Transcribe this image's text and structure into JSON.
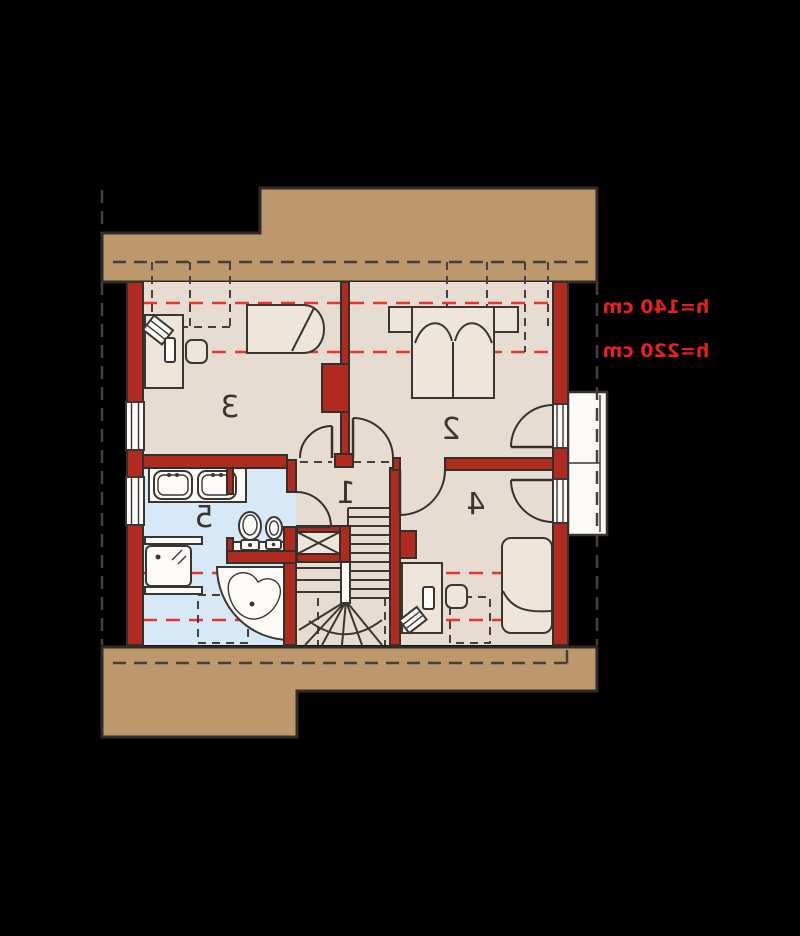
{
  "plan": {
    "rooms": [
      {
        "number": "1"
      },
      {
        "number": "2"
      },
      {
        "number": "3"
      },
      {
        "number": "4"
      },
      {
        "number": "5"
      }
    ],
    "height_labels": [
      {
        "text": "h=140 cm"
      },
      {
        "text": "h=220 cm"
      }
    ],
    "colors": {
      "background": "#000000",
      "roof_band": "#bd986c",
      "floor": "#e7dcd1",
      "bathroom_floor": "#d7e9f7",
      "wall_red": "#b02a20",
      "outline": "#33302c",
      "height_line_red": "#e8352b",
      "label_red": "#e8211d"
    }
  }
}
